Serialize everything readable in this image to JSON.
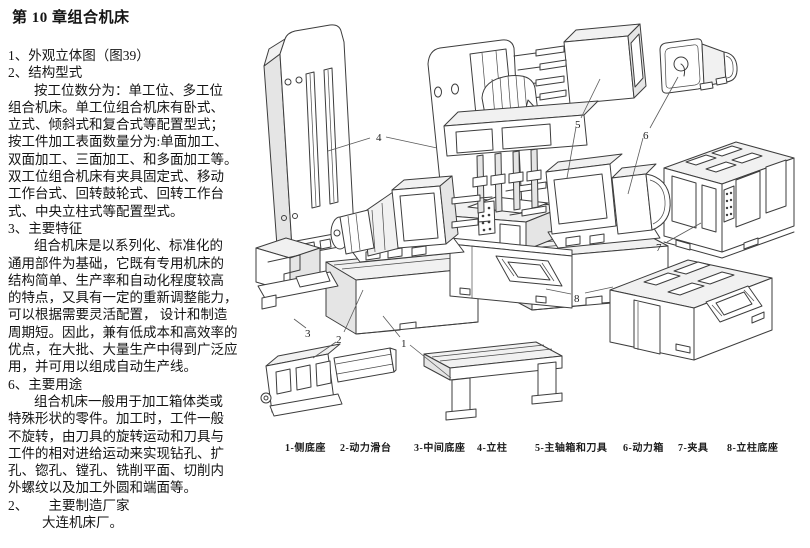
{
  "doc": {
    "title": "第 10 章组合机床",
    "lines": [
      "1、外观立体图（图39）",
      "2、结构型式",
      "按工位数分为：单工位、多工位",
      "组合机床。单工位组合机床有卧式、",
      "立式、倾斜式和复合式等配置型式；",
      "按工件加工表面数量分为:单面加工、",
      "双面加工、三面加工、和多面加工等。",
      "双工位组合机床有夹具固定式、移动",
      "工作台式、回转鼓轮式、回转工作台",
      "式、中央立柱式等配置型式。",
      "3、主要特征",
      "组合机床是以系列化、标准化的",
      "通用部件为基础，它既有专用机床的",
      "结构简单、生产率和自动化程度较高",
      "的特点，又具有一定的重新调整能力，",
      "可以根据需要灵活配置， 设计和制造",
      "周期短。因此，兼有低成本和高效率的",
      "优点，在大批、大量生产中得到广泛应",
      "用，并可用以组成自动生产线。",
      "6、主要用途",
      "组合机床一般用于加工箱体类或",
      "特殊形状的零件。加工时，工件一般",
      "不旋转，由刀具的旋转运动和刀具与",
      "工件的相对进给运动来实现钻孔、扩",
      "孔、锪孔、镗孔、铣削平面、切削内",
      "外螺纹以及加工外圆和端面等。",
      "2、　　主要制造厂家",
      "大连机床厂。"
    ]
  },
  "figure": {
    "callouts": [
      "1",
      "2",
      "3",
      "4",
      "5",
      "6",
      "7",
      "8"
    ],
    "caption": [
      "1-侧底座",
      "2-动力滑台",
      "3-中间底座",
      "4-立柱",
      "5-主轴箱和刀具",
      "6-动力箱",
      "7-夹具",
      "8-立柱底座"
    ]
  }
}
